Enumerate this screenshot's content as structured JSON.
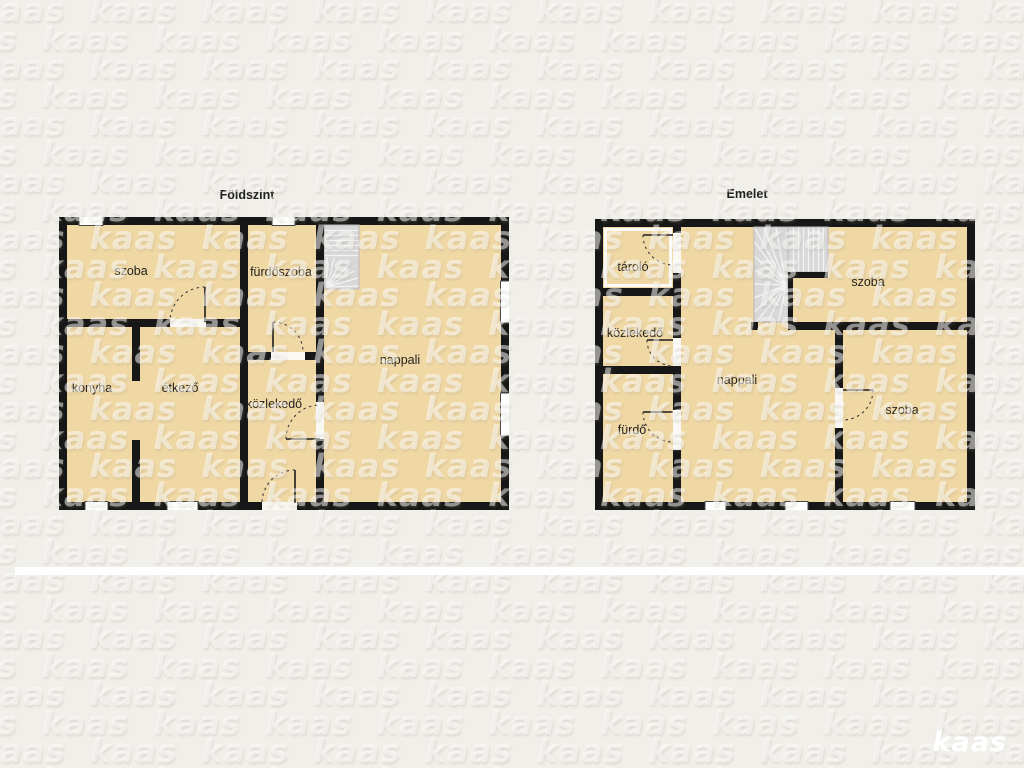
{
  "page": {
    "background": "#f1efea"
  },
  "branding": {
    "logo_text": "kaas",
    "watermark_text": "kaas"
  },
  "colors": {
    "wall": "#171717",
    "room_fill": "#f0d8a5",
    "stairs": "#d8d8d8",
    "window": "#ffffff",
    "divider": "#fefefe",
    "background": "#f1efea"
  },
  "floors": [
    {
      "title": "Földszint",
      "rooms": [
        {
          "label": "szoba"
        },
        {
          "label": "fürdőszoba"
        },
        {
          "label": "konyha"
        },
        {
          "label": "étkező"
        },
        {
          "label": "közlekedő"
        },
        {
          "label": "nappali"
        }
      ]
    },
    {
      "title": "Emelet",
      "rooms": [
        {
          "label": "tároló"
        },
        {
          "label": "közlekedő"
        },
        {
          "label": "fürdő"
        },
        {
          "label": "nappali"
        },
        {
          "label": "szoba"
        },
        {
          "label": "szoba"
        }
      ]
    }
  ]
}
